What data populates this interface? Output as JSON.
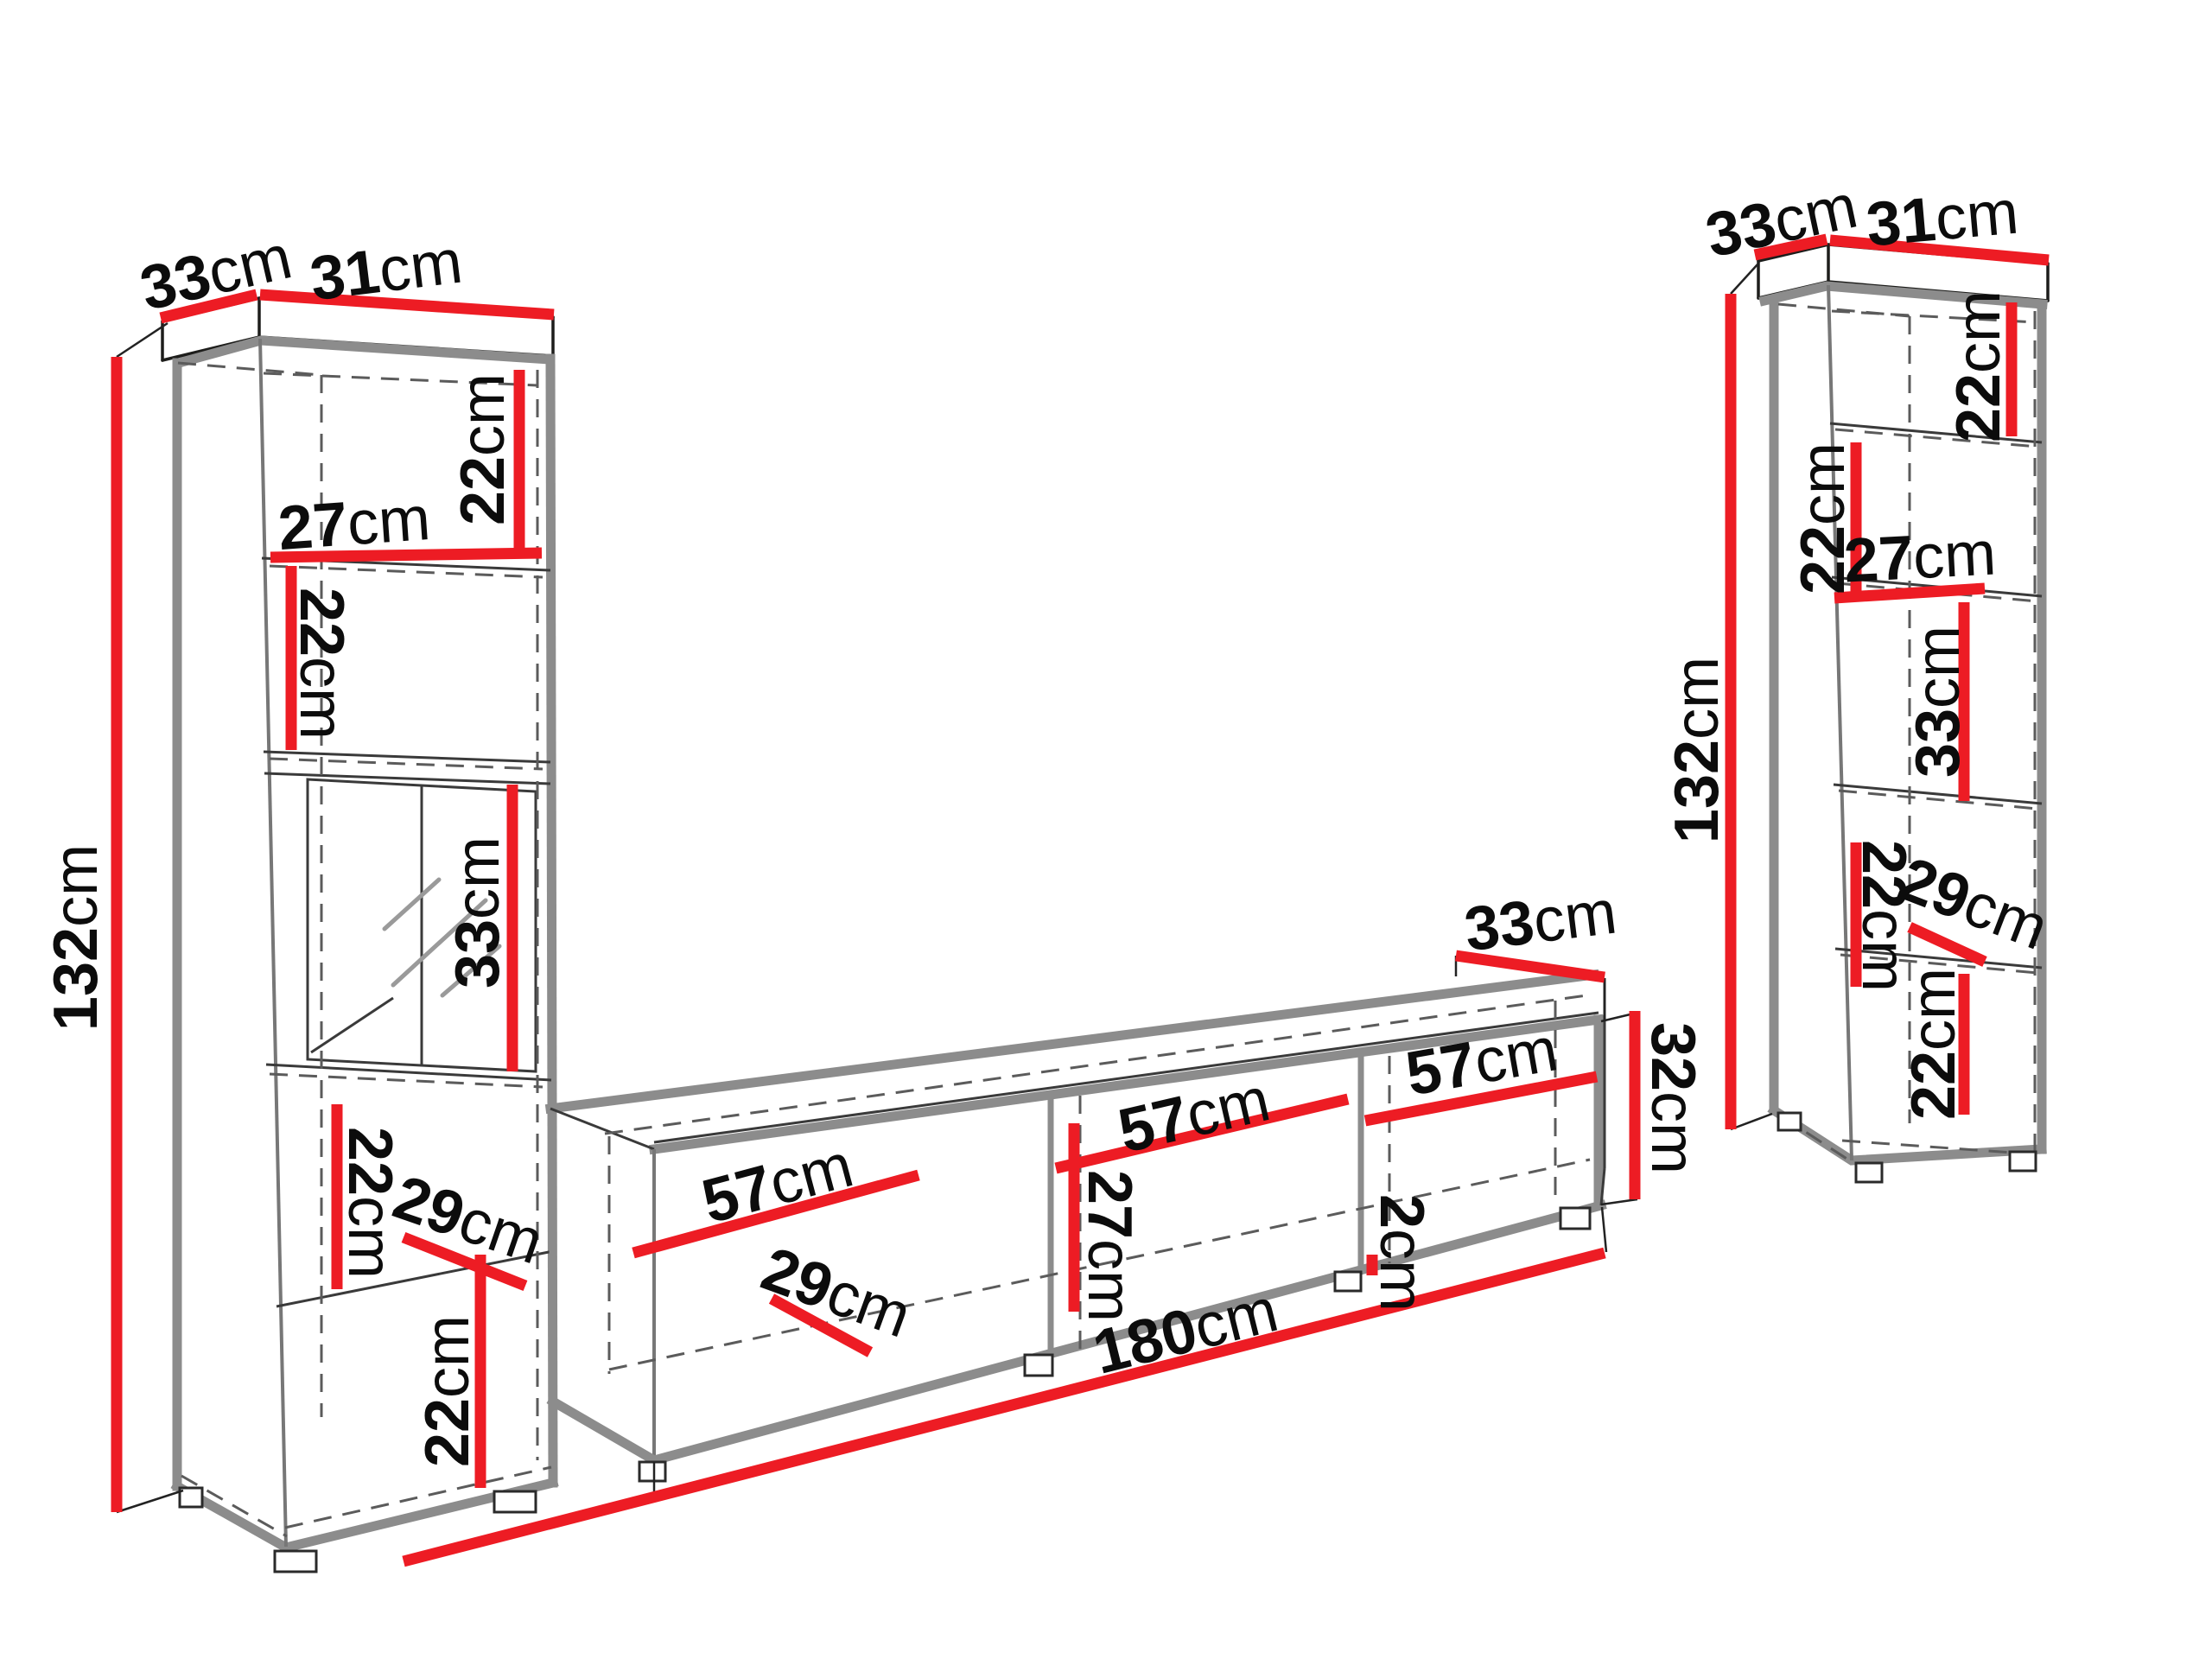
{
  "diagram": {
    "kind": "furniture-dimension-diagram",
    "description": "Wall unit set: two tall display cabinets and a TV stand with red dimension lines",
    "unit": "cm"
  },
  "colors": {
    "dimension_line": "#ed1c24",
    "panel_edge": "#8c8c8c",
    "outline": "#1d1d1b",
    "dashed": "#5b5b5b",
    "text": "#0c0c0c",
    "background": "#ffffff"
  },
  "pieces": {
    "left_cabinet": {
      "name": "left tall display cabinet",
      "labels": {
        "depth_top": {
          "v": "33",
          "u": "cm"
        },
        "width_top": {
          "v": "31",
          "u": "cm"
        },
        "height": {
          "v": "132",
          "u": "cm"
        },
        "shelf1_height": {
          "v": "22",
          "u": "cm"
        },
        "shelf1_width": {
          "v": "27",
          "u": "cm"
        },
        "shelf2_height": {
          "v": "22",
          "u": "cm"
        },
        "glass_section_height": {
          "v": "33",
          "u": "cm"
        },
        "shelf4_height": {
          "v": "22",
          "u": "cm"
        },
        "inner_depth": {
          "v": "29",
          "u": "cm"
        },
        "shelf5_height": {
          "v": "22",
          "u": "cm"
        }
      }
    },
    "tv_stand": {
      "name": "tv stand",
      "labels": {
        "depth_top": {
          "v": "33",
          "u": "cm"
        },
        "bay1_width": {
          "v": "57",
          "u": "cm"
        },
        "bay2_width": {
          "v": "57",
          "u": "cm"
        },
        "bay3_width": {
          "v": "57",
          "u": "cm"
        },
        "inner_height": {
          "v": "27",
          "u": "cm"
        },
        "inner_depth": {
          "v": "29",
          "u": "cm"
        },
        "panel_thickness": {
          "v": "2",
          "u": "cm"
        },
        "total_width": {
          "v": "180",
          "u": "cm"
        },
        "height": {
          "v": "32",
          "u": "cm"
        }
      }
    },
    "right_cabinet": {
      "name": "right tall display cabinet",
      "labels": {
        "depth_top": {
          "v": "33",
          "u": "cm"
        },
        "width_top": {
          "v": "31",
          "u": "cm"
        },
        "height": {
          "v": "132",
          "u": "cm"
        },
        "shelf1_height": {
          "v": "22",
          "u": "cm"
        },
        "shelf2_height": {
          "v": "22",
          "u": "cm"
        },
        "shelf2_width": {
          "v": "27",
          "u": "cm"
        },
        "glass_section_height": {
          "v": "33",
          "u": "cm"
        },
        "shelf4_height": {
          "v": "22",
          "u": "cm"
        },
        "inner_depth": {
          "v": "29",
          "u": "cm"
        },
        "shelf5_height": {
          "v": "22",
          "u": "cm"
        }
      }
    }
  }
}
